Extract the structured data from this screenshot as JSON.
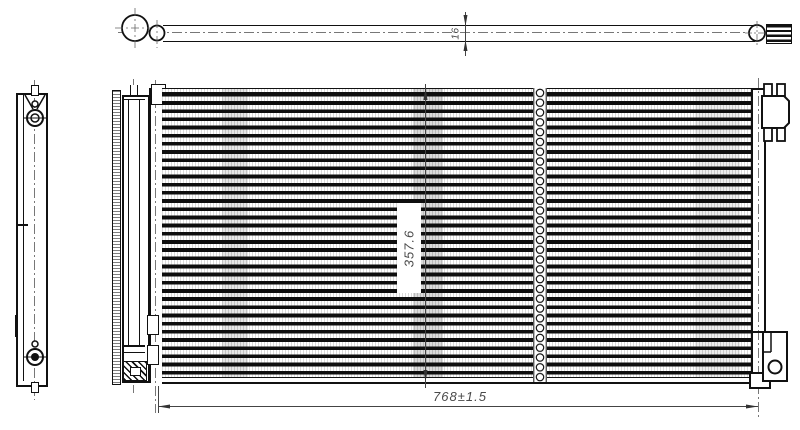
{
  "drawing": {
    "description": "technical line drawing of automotive condenser: top view, left side view and front view of finned tube core with receiver drier and mounting brackets",
    "dimensions": {
      "tube_depth": "16",
      "core_height": "357.6",
      "overall_width": "768±1.5"
    },
    "colors": {
      "line": "#111111",
      "dimension_text": "#4a4a4a",
      "background": "#ffffff"
    }
  }
}
